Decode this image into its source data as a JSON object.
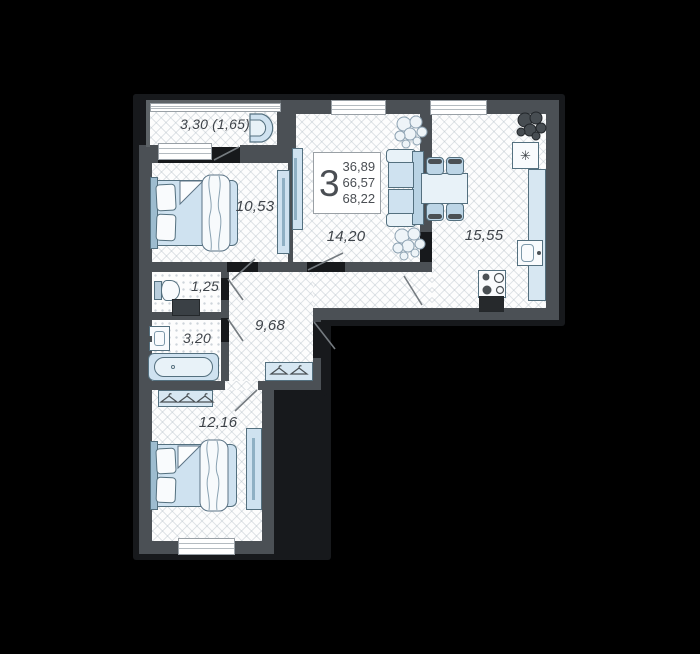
{
  "unit": {
    "rooms_count": "3",
    "areas": {
      "living": "36,89",
      "main": "66,57",
      "total": "68,22"
    }
  },
  "rooms": [
    {
      "name": "balcony",
      "area": "3,30 (1,65)"
    },
    {
      "name": "bedroom-1",
      "area": "10,53"
    },
    {
      "name": "living-room",
      "area": "14,20"
    },
    {
      "name": "kitchen",
      "area": "15,55"
    },
    {
      "name": "wc",
      "area": "1,25"
    },
    {
      "name": "bathroom",
      "area": "3,20"
    },
    {
      "name": "hallway",
      "area": "9,68"
    },
    {
      "name": "bedroom-2",
      "area": "12,16"
    }
  ],
  "icons": {
    "fridge_snowflake": "✳"
  },
  "colors": {
    "background": "#000000",
    "wall": "#4b5055",
    "furniture": "#cfe2f0",
    "furniture_stroke": "#54707f",
    "floor": "#fdfdfd"
  }
}
